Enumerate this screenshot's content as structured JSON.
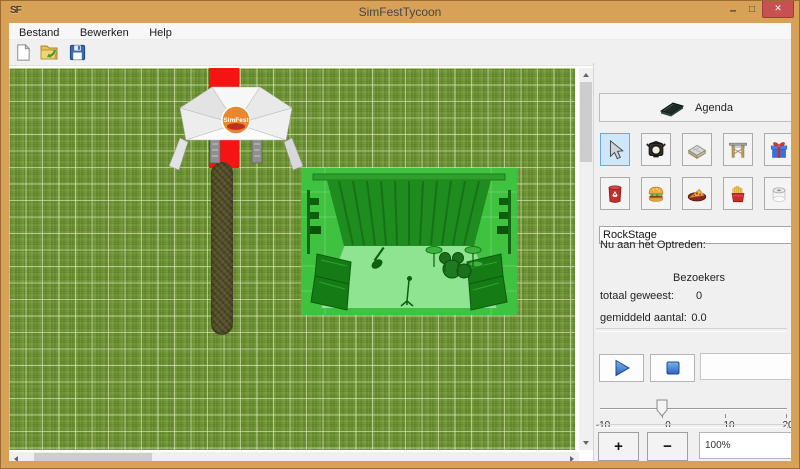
{
  "window": {
    "title": "SimFestTycoon",
    "app_icon_text": "SF",
    "minimize_glyph": "–",
    "maximize_glyph": "□",
    "close_glyph": "✕"
  },
  "menu": {
    "items": [
      {
        "label": "Bestand"
      },
      {
        "label": "Bewerken"
      },
      {
        "label": "Help"
      }
    ]
  },
  "toolbar": {
    "icons": [
      "new-file",
      "open-file",
      "save-file"
    ]
  },
  "canvas": {
    "tent_logo": "SimFest",
    "objects": [
      "entrance-tent",
      "red-carpet",
      "dirt-path",
      "stage-preview"
    ]
  },
  "sidebar": {
    "agenda_label": "Agenda",
    "tools_row1": [
      "select-cursor",
      "spotlight",
      "path-tile",
      "gate",
      "gift"
    ],
    "tools_row2": [
      "trash-can",
      "burger",
      "pizza",
      "fries",
      "toilet-roll"
    ],
    "selected_tool": "select-cursor",
    "stage_name_value": "RockStage",
    "now_performing_label": "Nu aan het Optreden:",
    "visitors_header": "Bezoekers",
    "stats": [
      {
        "label": "totaal geweest:",
        "value": "0"
      },
      {
        "label": "gemiddeld aantal:",
        "value": "0.0"
      }
    ],
    "slider": {
      "min": -10,
      "max": 20,
      "value": 0,
      "tick_labels": [
        "-10",
        "0",
        "10",
        "20"
      ]
    },
    "zoom": {
      "in_label": "+",
      "out_label": "−",
      "level": "100%"
    }
  },
  "colors": {
    "window_chrome": "#d7a257",
    "close_button": "#c85050",
    "selected_tool_bg": "#cfe7fa",
    "grass": "#6f9434",
    "carpet_red": "#f51414",
    "path_brown": "#57512c",
    "stage_tint": "#3fc23f"
  }
}
